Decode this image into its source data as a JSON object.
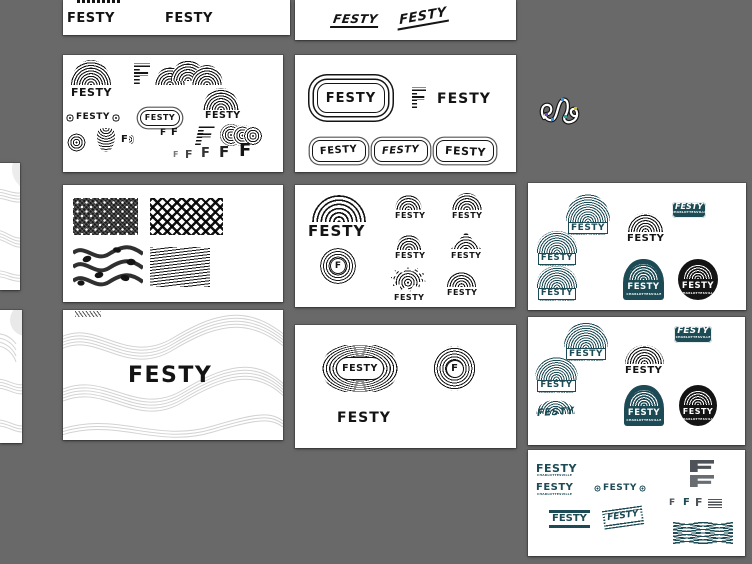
{
  "canvas": {
    "background": "#696969",
    "artboard_background": "#ffffff"
  },
  "palette": {
    "ink": "#141414",
    "teal": "#1d4b55",
    "slate": "#4d5358",
    "wave_gray": "#d4d4d4",
    "squiggle_anchor_colors": [
      "#3f8fd2",
      "#7b3fd2",
      "#c9b93f",
      "#2aa4a0"
    ]
  },
  "brand": {
    "wordmark": "FESTY",
    "letter": "F",
    "city": "CHARLOTTESVILLE"
  }
}
